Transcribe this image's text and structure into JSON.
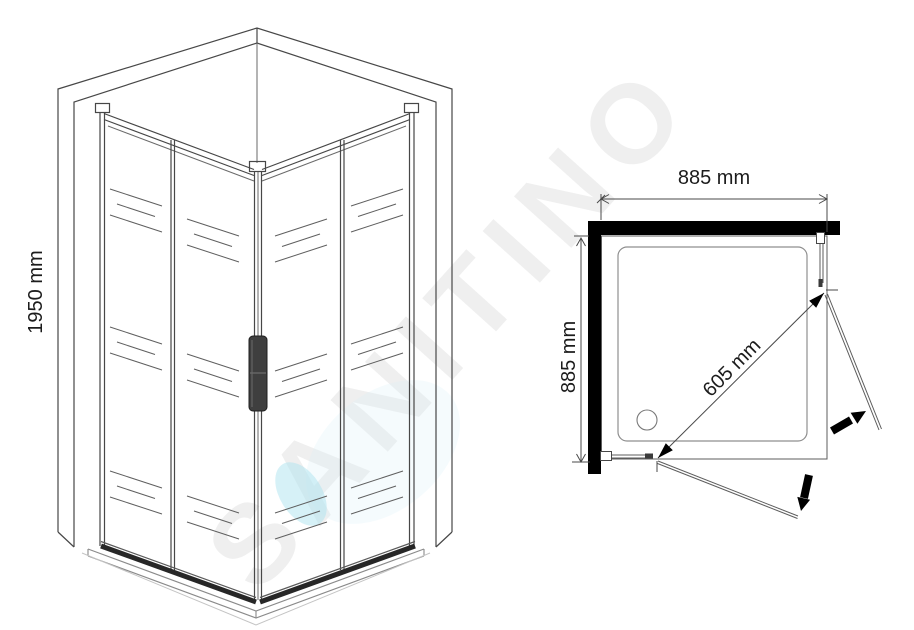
{
  "drawing": {
    "subject": "corner shower enclosure technical drawing",
    "views": [
      "isometric-view",
      "plan-view"
    ]
  },
  "watermark": {
    "text": "SANITINO",
    "gray_color": "#ececec",
    "drop_color": "#aee3ef"
  },
  "isometric_view": {
    "height_label": "1950 mm"
  },
  "plan_view": {
    "width_label": "885 mm",
    "depth_label": "885 mm",
    "opening_label": "605 mm",
    "wall_color": "#000000",
    "arrow_color": "#000000"
  }
}
